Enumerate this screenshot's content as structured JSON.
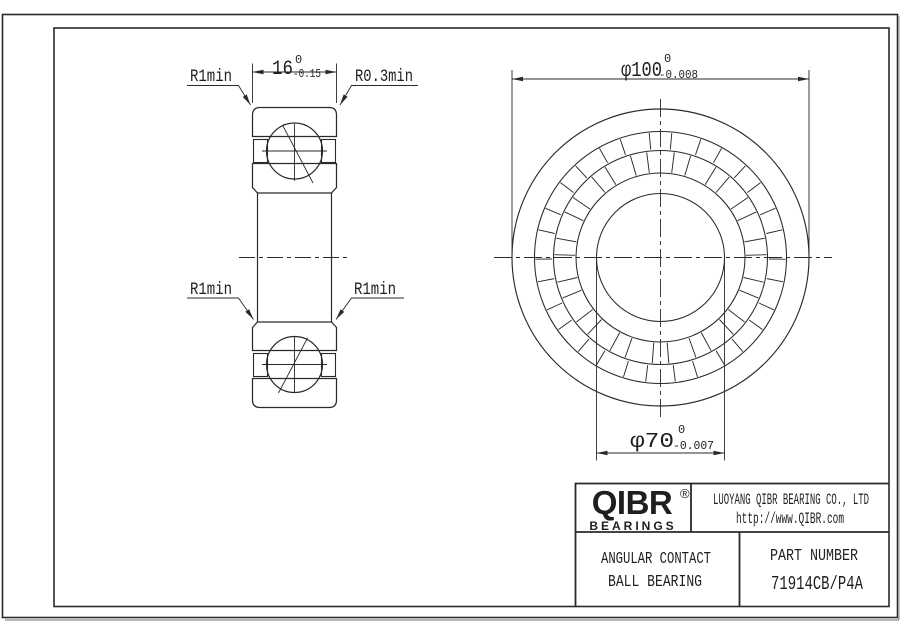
{
  "drawing": {
    "dims": {
      "width": {
        "main": "16",
        "tol_top": "0",
        "tol_bottom": "-0.15"
      },
      "outer_dia": {
        "main": "φ100",
        "tol_top": "0",
        "tol_bottom": "-0.008"
      },
      "bore_dia": {
        "main": "φ70",
        "tol_top": "0",
        "tol_bottom": "-0.007"
      }
    },
    "leaders": {
      "top_left": "R1min",
      "top_right": "R0.3min",
      "mid_left": "R1min",
      "mid_right": "R1min"
    },
    "front_view": {
      "ball_count": 15
    },
    "title_block": {
      "logo": {
        "name": "QIBR",
        "registered": "®",
        "sub": "BEARINGS"
      },
      "company_line1": "LUOYANG QIBR BEARING CO., LTD",
      "company_line2": "http://www.QIBR.com",
      "product_line1": "ANGULAR CONTACT",
      "product_line2": "BALL BEARING",
      "part_label": "PART NUMBER",
      "part_number": "71914CB/P4A"
    },
    "colors": {
      "line": "#2a2a2a",
      "background": "#ffffff"
    }
  }
}
